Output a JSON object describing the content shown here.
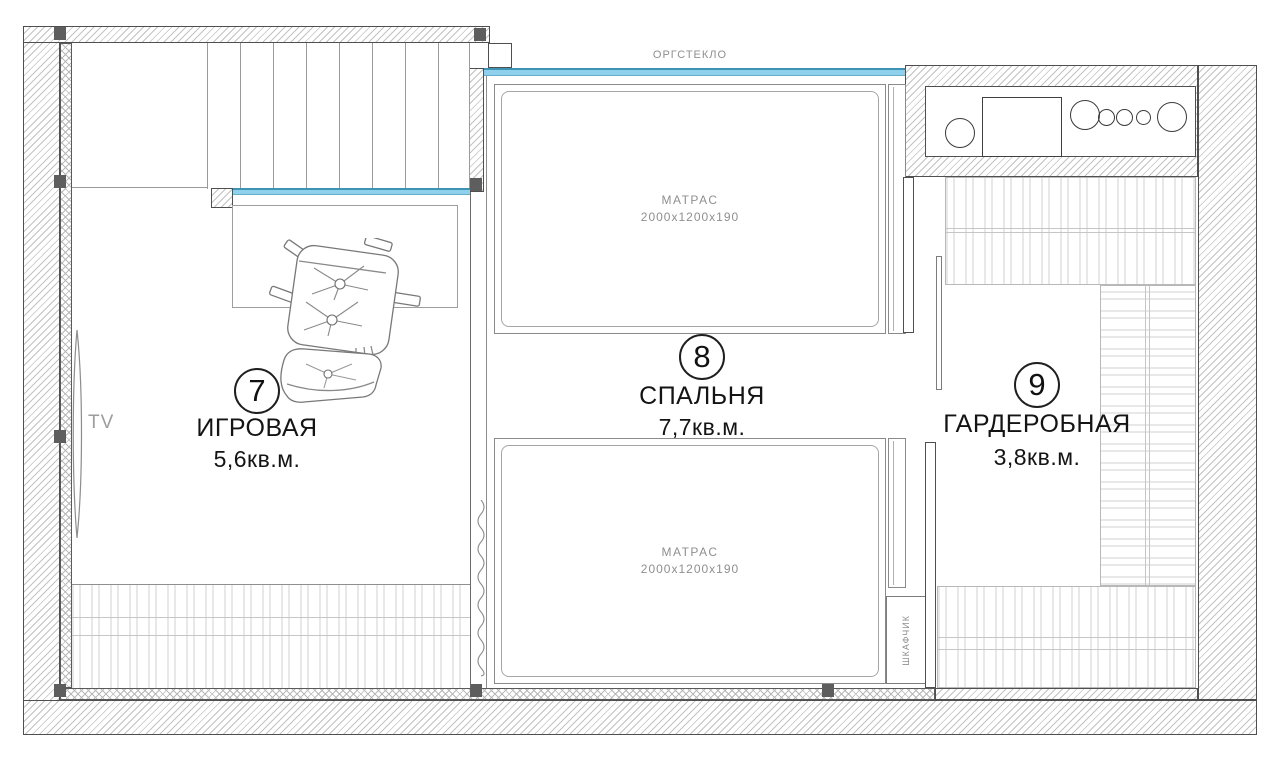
{
  "plan_title": "floor-plan-second-level",
  "glass_label": "ОРГСТЕКЛО",
  "rooms": {
    "playroom": {
      "number": "7",
      "name": "ИГРОВАЯ",
      "area": "5,6кв.м."
    },
    "bedroom": {
      "number": "8",
      "name": "СПАЛЬНЯ",
      "area": "7,7кв.м."
    },
    "wardrobe": {
      "number": "9",
      "name": "ГАРДЕРОБНАЯ",
      "area": "3,8кв.м."
    }
  },
  "furniture": {
    "mattress_label": "МАТРАС",
    "mattress_size": "2000х1200х190",
    "tv_label": "TV",
    "cabinet_label": "ШКАФЧИК"
  },
  "colors": {
    "glass_fill": "#8FD1EC",
    "glass_border": "#3F93B5",
    "wall_outline": "#4f4f4f",
    "hatch_line": "#c2c2c2",
    "column_fill": "#5e5e5e",
    "text_dark": "#141414",
    "text_gray": "#8f8f8f",
    "furniture_pattern": "#e8e8e8"
  }
}
